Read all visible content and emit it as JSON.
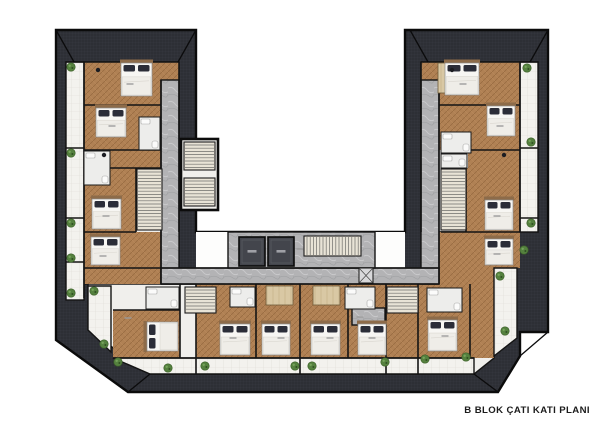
{
  "caption": {
    "text": "B BLOK ÇATI KATI PLANI"
  },
  "palette": {
    "roof": "#2d2f35",
    "roof_grid": "#3a3c44",
    "wall": "#141414",
    "wood": "#b08154",
    "wood_line": "#96693f",
    "light_wood": "#d9c8a4",
    "marble": "#b3b3b5",
    "balcony": "#f3f2ee",
    "interior": "#f0efec",
    "bed_sheet": "#f7f6f3",
    "pillow": "#2b2d38",
    "headboard": "#8d6b49",
    "plant": "#55813f",
    "plant_dark": "#3c6129",
    "elevator": "#43454c",
    "stair_fill": "#e8e3d6",
    "caption": "#1b1b1b"
  },
  "plan": {
    "beds": [
      {
        "x": 121,
        "y": 63,
        "w": 31,
        "h": 33,
        "dir": "n"
      },
      {
        "x": 96,
        "y": 108,
        "w": 30,
        "h": 29,
        "dir": "n"
      },
      {
        "x": 92,
        "y": 199,
        "w": 29,
        "h": 30,
        "dir": "n"
      },
      {
        "x": 91,
        "y": 237,
        "w": 29,
        "h": 28,
        "dir": "n"
      },
      {
        "x": 445,
        "y": 63,
        "w": 34,
        "h": 32,
        "dir": "n"
      },
      {
        "x": 487,
        "y": 106,
        "w": 28,
        "h": 30,
        "dir": "n"
      },
      {
        "x": 485,
        "y": 200,
        "w": 28,
        "h": 30,
        "dir": "n"
      },
      {
        "x": 485,
        "y": 239,
        "w": 28,
        "h": 26,
        "dir": "n"
      },
      {
        "x": 147,
        "y": 322,
        "w": 31,
        "h": 29,
        "dir": "w"
      },
      {
        "x": 220,
        "y": 324,
        "w": 30,
        "h": 31,
        "dir": "n"
      },
      {
        "x": 262,
        "y": 324,
        "w": 28,
        "h": 31,
        "dir": "n"
      },
      {
        "x": 311,
        "y": 324,
        "w": 29,
        "h": 31,
        "dir": "n"
      },
      {
        "x": 358,
        "y": 324,
        "w": 28,
        "h": 31,
        "dir": "n"
      },
      {
        "x": 428,
        "y": 320,
        "w": 29,
        "h": 31,
        "dir": "n"
      }
    ],
    "plants": [
      [
        71,
        67
      ],
      [
        71,
        153
      ],
      [
        71,
        223
      ],
      [
        71,
        258
      ],
      [
        71,
        293
      ],
      [
        94,
        291
      ],
      [
        104,
        344
      ],
      [
        118,
        362
      ],
      [
        168,
        368
      ],
      [
        205,
        366
      ],
      [
        295,
        366
      ],
      [
        312,
        366
      ],
      [
        385,
        362
      ],
      [
        425,
        359
      ],
      [
        466,
        357
      ],
      [
        500,
        276
      ],
      [
        505,
        331
      ],
      [
        527,
        68
      ],
      [
        531,
        142
      ],
      [
        531,
        223
      ],
      [
        524,
        250
      ]
    ],
    "stairs": [
      {
        "x": 184,
        "y": 142,
        "w": 31,
        "h": 28,
        "dir": "v"
      },
      {
        "x": 184,
        "y": 178,
        "w": 31,
        "h": 28,
        "dir": "v"
      },
      {
        "x": 137,
        "y": 169,
        "w": 25,
        "h": 61,
        "dir": "v"
      },
      {
        "x": 441,
        "y": 169,
        "w": 25,
        "h": 61,
        "dir": "v"
      },
      {
        "x": 304,
        "y": 236,
        "w": 57,
        "h": 20,
        "dir": "h"
      },
      {
        "x": 185,
        "y": 287,
        "w": 31,
        "h": 26,
        "dir": "v"
      },
      {
        "x": 387,
        "y": 287,
        "w": 31,
        "h": 26,
        "dir": "v"
      }
    ],
    "elevators": [
      {
        "x": 239,
        "y": 237,
        "w": 26,
        "h": 29
      },
      {
        "x": 268,
        "y": 237,
        "w": 26,
        "h": 29
      }
    ],
    "baths": [
      {
        "x": 84,
        "y": 151,
        "w": 26,
        "h": 34
      },
      {
        "x": 139,
        "y": 117,
        "w": 21,
        "h": 33
      },
      {
        "x": 441,
        "y": 132,
        "w": 30,
        "h": 21
      },
      {
        "x": 441,
        "y": 154,
        "w": 26,
        "h": 14
      },
      {
        "x": 146,
        "y": 287,
        "w": 33,
        "h": 22
      },
      {
        "x": 230,
        "y": 287,
        "w": 25,
        "h": 20
      },
      {
        "x": 345,
        "y": 287,
        "w": 30,
        "h": 22
      },
      {
        "x": 427,
        "y": 288,
        "w": 35,
        "h": 24
      }
    ],
    "wardrobes": [
      {
        "x": 266,
        "y": 286,
        "w": 27,
        "h": 19
      },
      {
        "x": 313,
        "y": 286,
        "w": 27,
        "h": 19
      },
      {
        "x": 438,
        "y": 63,
        "w": 14,
        "h": 30
      }
    ],
    "shafts": [
      {
        "x": 359,
        "y": 268,
        "w": 14,
        "h": 15
      }
    ],
    "label_marks": [
      [
        130,
        84
      ],
      [
        112,
        126
      ],
      [
        106,
        216
      ],
      [
        103,
        256
      ],
      [
        128,
        318
      ],
      [
        233,
        338
      ],
      [
        281,
        338
      ],
      [
        330,
        338
      ],
      [
        372,
        338
      ],
      [
        445,
        336
      ],
      [
        463,
        84
      ],
      [
        500,
        126
      ],
      [
        497,
        216
      ],
      [
        497,
        254
      ],
      [
        300,
        249
      ],
      [
        360,
        317
      ]
    ],
    "decor_dots": [
      [
        98,
        70
      ],
      [
        104,
        155
      ],
      [
        452,
        70
      ],
      [
        504,
        155
      ]
    ]
  }
}
